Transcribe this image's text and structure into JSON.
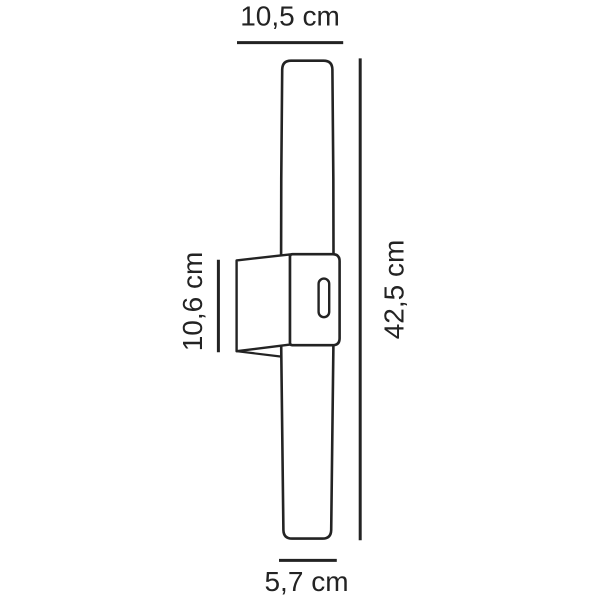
{
  "diagram": {
    "background_color": "#ffffff",
    "line_color": "#232323",
    "subject": "wall-lamp-dimension-drawing",
    "labels": {
      "depth_top": "10,5 cm",
      "height_right": "42,5 cm",
      "bracket_height_left": "10,6 cm",
      "diameter_bottom": "5,7 cm"
    }
  }
}
